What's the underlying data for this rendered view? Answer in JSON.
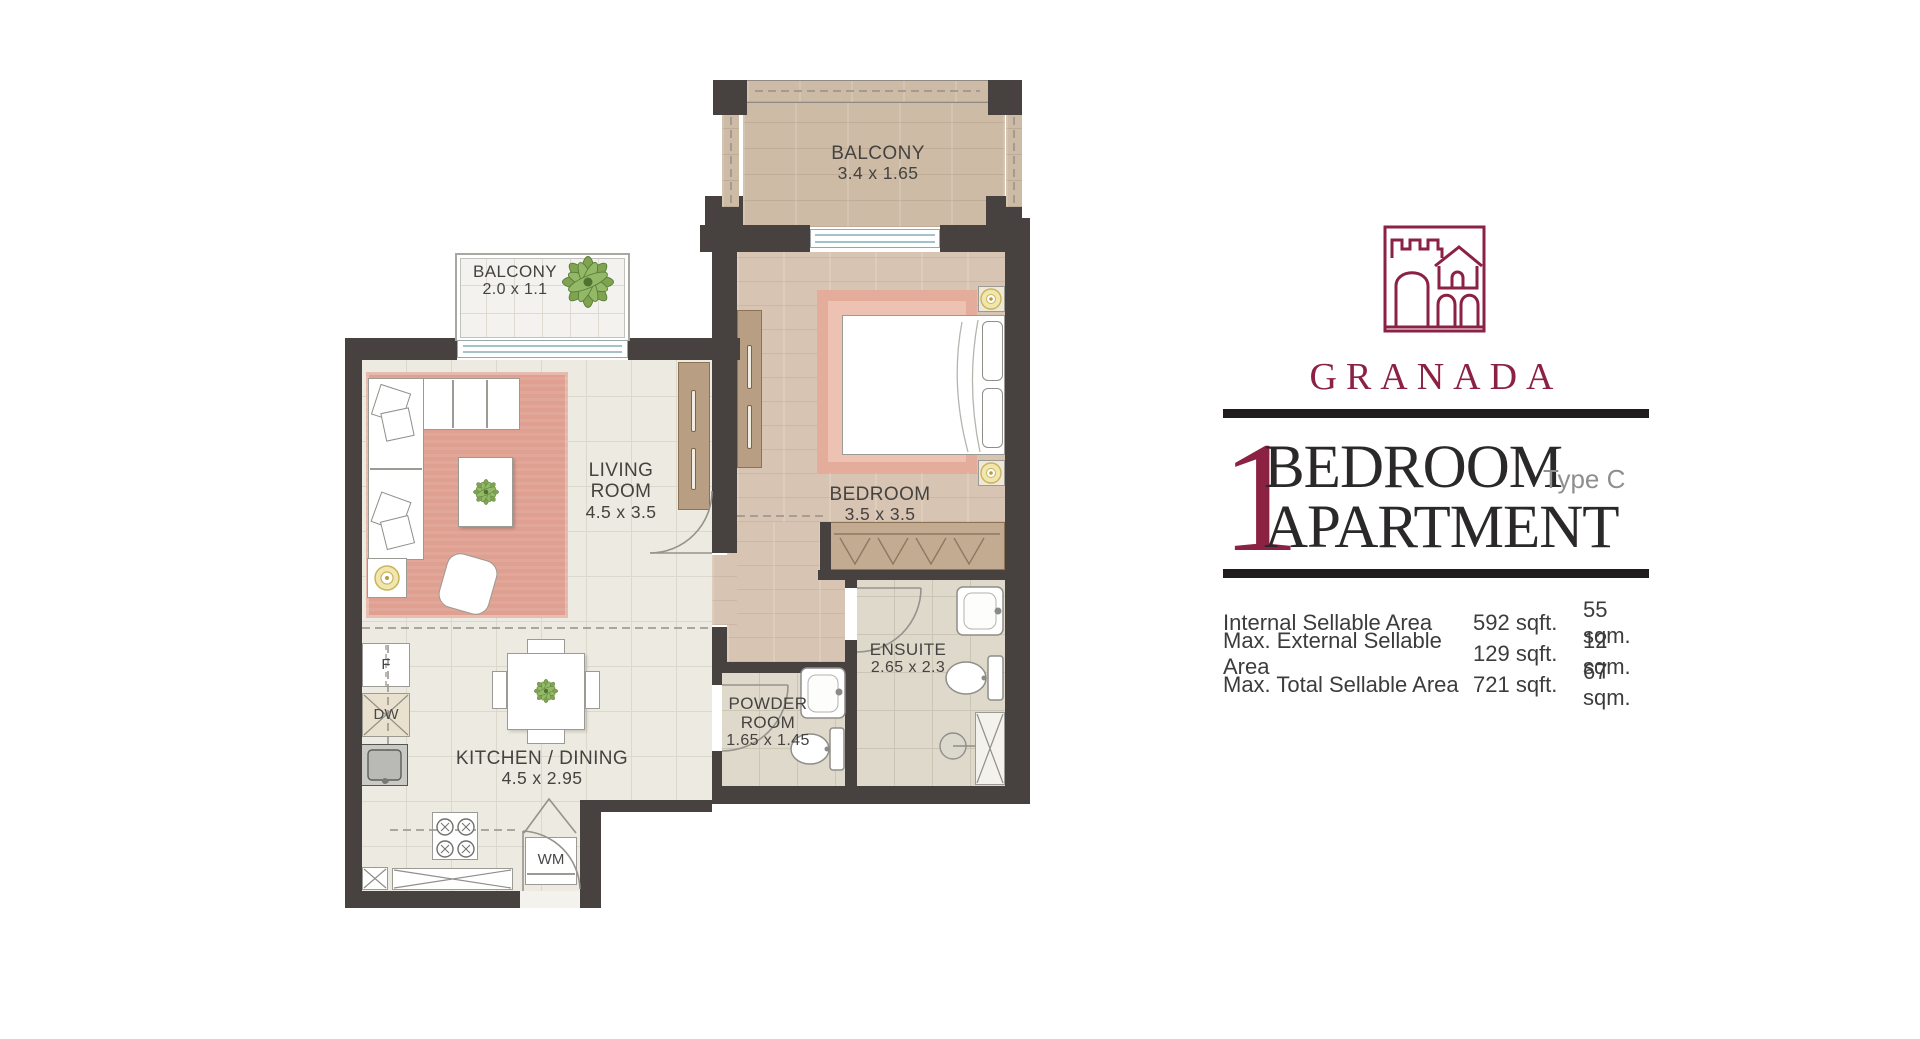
{
  "brand": {
    "name": "GRANADA",
    "logo_color": "#8b2143"
  },
  "title": {
    "number": "1",
    "line1": "BEDROOM",
    "line2": "APARTMENT",
    "variant": "Type C"
  },
  "area_table": {
    "rows": [
      {
        "label": "Internal Sellable Area",
        "sqft": "592 sqft.",
        "sqm": "55 sqm."
      },
      {
        "label": "Max. External Sellable Area",
        "sqft": "129 sqft.",
        "sqm": "12 sqm."
      },
      {
        "label": "Max. Total Sellable Area",
        "sqft": "721 sqft.",
        "sqm": "67 sqm."
      }
    ]
  },
  "floorplan": {
    "labels": {
      "balcony_top": {
        "name": "BALCONY",
        "dims": "3.4 x 1.65"
      },
      "balcony_side": {
        "name": "BALCONY",
        "dims": "2.0 x 1.1"
      },
      "living": {
        "name": "LIVING ROOM",
        "dims": "4.5 x 3.5"
      },
      "bedroom": {
        "name": "BEDROOM",
        "dims": "3.5 x 3.5"
      },
      "ensuite": {
        "name": "ENSUITE",
        "dims": "2.65 x 2.3"
      },
      "powder": {
        "name": "POWDER ROOM",
        "dims": "1.65 x 1.45"
      },
      "kitchen": {
        "name": "KITCHEN / DINING",
        "dims": "4.5 x 2.95"
      }
    },
    "appliances": {
      "fridge": "F",
      "dishwasher": "DW",
      "washing_machine": "WM"
    }
  }
}
